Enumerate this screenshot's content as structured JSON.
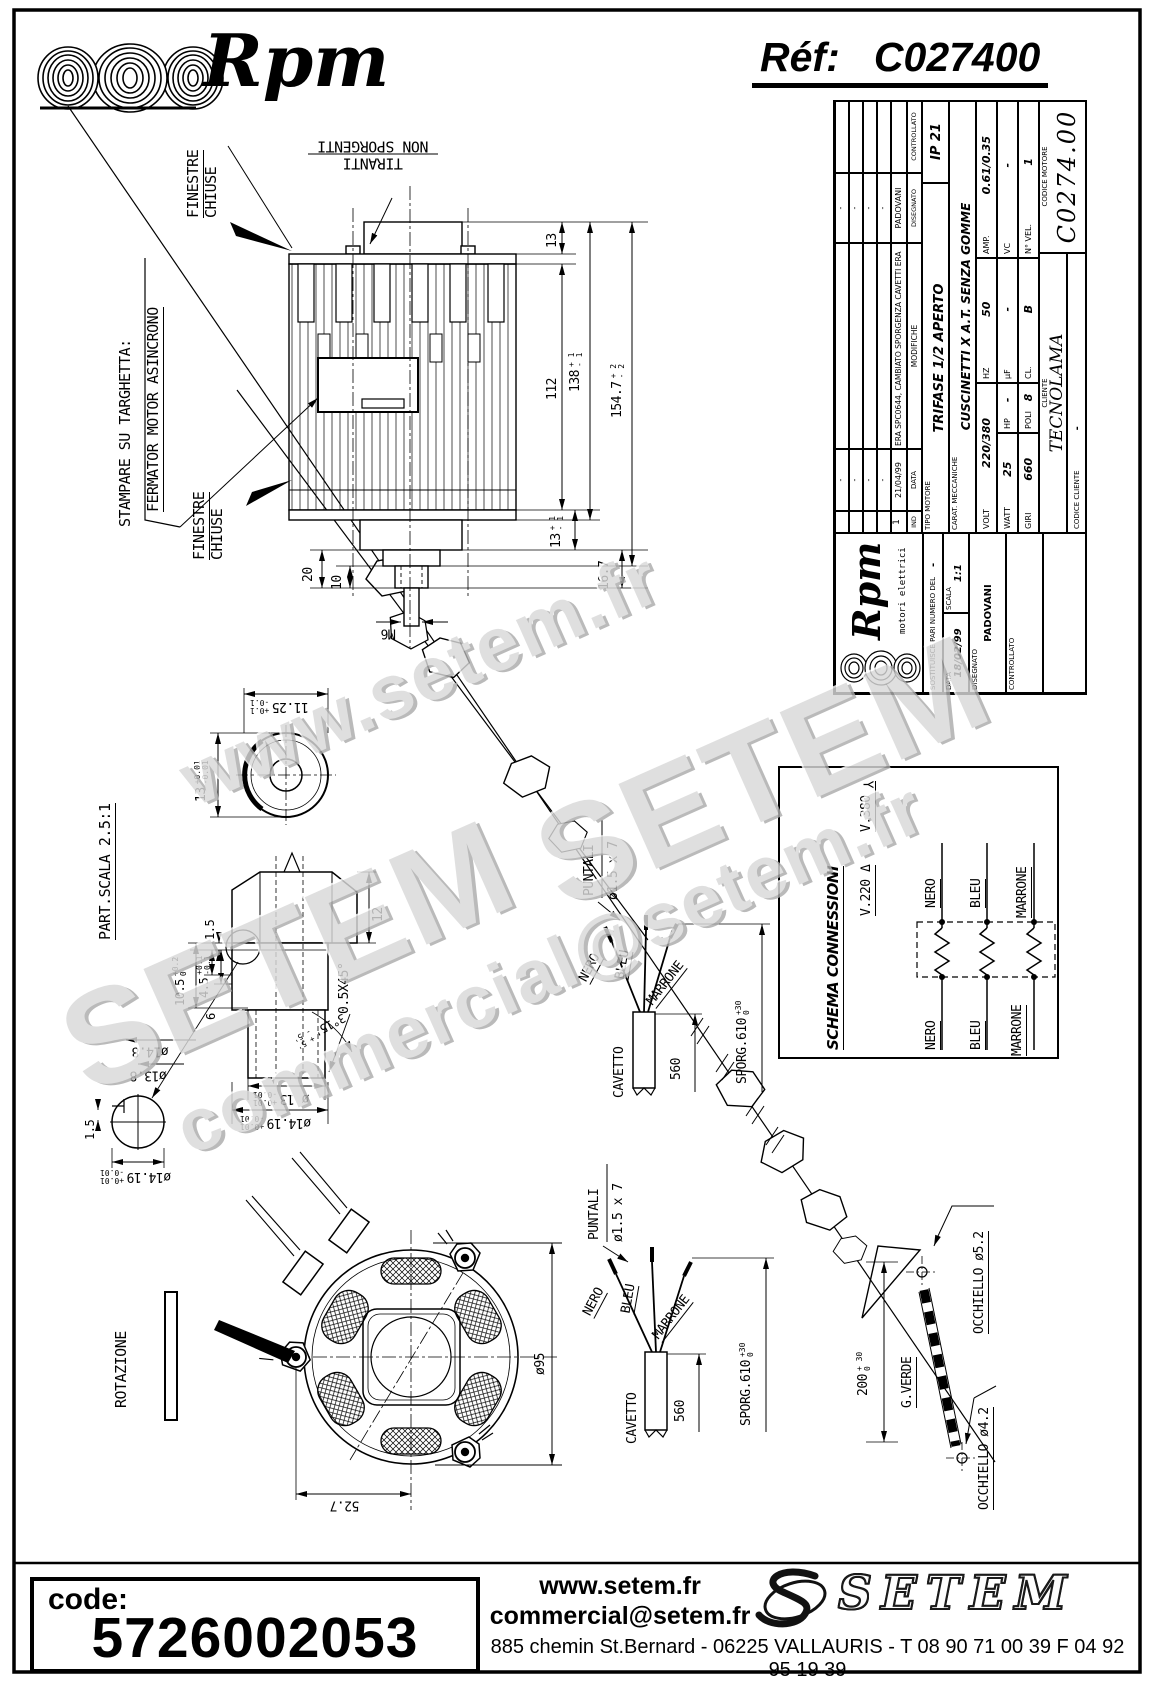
{
  "header": {
    "brand": "Rpm",
    "ref_label": "Réf:",
    "ref_value": "C027400"
  },
  "watermarks": {
    "w1": "www.setem.fr",
    "w2": "SETEM",
    "w3": "SETEM",
    "w4": "commercial@setem.fr"
  },
  "notes": {
    "finestre_a": "FINESTRE",
    "finestre_b": "CHIUSE",
    "tiranti_a": "TIRANTI",
    "tiranti_b": "NON SPORGENTI",
    "stampare_a": "STAMPARE SU TARGHETTA:",
    "stampare_b": "FERMATOR MOTOR ASINCRONO",
    "part_scala": "PART.SCALA 2.5:1",
    "rotazione": "ROTAZIONE",
    "m6": "M6"
  },
  "dims": {
    "d13": "13",
    "d112": "112",
    "d138": "138",
    "d138_tp": "+ 1",
    "d138_tm": "- 1",
    "d154": "154.7",
    "d154_tp": "+ 2",
    "d154_tm": "- 2",
    "d13b": "13",
    "d13b_tp": "+ 1",
    "d13b_tm": "- 1",
    "d167": "16.7",
    "d20": "20",
    "d10": "10",
    "d1125": "11.25",
    "d1125_tp": "+0.1",
    "d1125_tm": "-0.1",
    "d13c": "13",
    "d13c_tp": "+0.01",
    "d13c_tm": "-0.01",
    "d15": "1.5",
    "d105": "10.5",
    "d105_tp": "+0.2",
    "d105_tm": "0",
    "d45": "4.5",
    "d45_tp": "+0.1",
    "d45_tm": "-0.1",
    "d6": "6",
    "d12": "12",
    "d05x45": "0.5X45°",
    "d315": "3°15'",
    "d315_tp": "+ 5'",
    "d315_tm": "- 5'",
    "dia13": "ø 13",
    "dia13_tp": "+0.01",
    "dia13_tm": "-0.01",
    "dia1419": "ø14.19",
    "dia1419_tp": "+0.01",
    "dia1419_tm": "-0.01",
    "dia148": "ø14.8",
    "dia138": "ø13.8",
    "dia95": "ø95",
    "d527": "52.7",
    "d560": "560",
    "sporg": "SPORG.610",
    "sporg_tp": "+30",
    "sporg_tm": "0",
    "d200": "200",
    "d200_tp": "+ 30",
    "d200_tm": "0"
  },
  "cable": {
    "puntali": "PUNTALI",
    "puntali_size": "ø1.5 x 7",
    "cavetto": "CAVETTO",
    "nero": "NERO",
    "bleu": "BLEU",
    "marrone": "MARRONE",
    "gverde": "G.VERDE",
    "occ52": "OCCHIELLO ø5.2",
    "occ42": "OCCHIELLO ø4.2"
  },
  "schema": {
    "title": "SCHEMA CONNESSIONI",
    "v220": "V.220",
    "delta": "Δ",
    "v380": "V.380",
    "wye": "Y",
    "nero": "NERO",
    "bleu": "BLEU",
    "marrone": "MARRONE"
  },
  "title_block": {
    "dash": "-",
    "rev1_ind": "1",
    "rev1_date": "21/04/99",
    "rev1_desc": "ERA SPC0644, CAMBIATO SPORGENZA CAVETTI ERA 140",
    "rev1_name": "PADOVANI",
    "h_ind": "IND",
    "h_data": "DATA",
    "h_mod": "MODIFICHE",
    "h_dis": "DISEGNATO",
    "h_ctrl": "CONTROLLATO",
    "tipo_l": "TIPO MOTORE",
    "tipo_v": "TRIFASE 1/2 APERTO",
    "ip": "IP 21",
    "carat_l": "CARAT. MECCANICHE",
    "carat_v": "CUSCINETTI X A.T. SENZA GOMME",
    "volt_l": "VOLT",
    "volt_v": "220/380",
    "hz_l": "HZ",
    "hz_v": "50",
    "amp_l": "AMP.",
    "amp_v": "0.61/0.35",
    "watt_l": "WATT",
    "watt_v": "25",
    "hp_l": "HP",
    "hp_v": "-",
    "uf_l": "µF",
    "uf_v": "-",
    "vc_l": "VC",
    "vc_v": "-",
    "giri_l": "GIRI",
    "giri_v": "660",
    "poli_l": "POLI",
    "poli_v": "8",
    "cl_l": "CL.",
    "cl_v": "B",
    "nvel_l": "N° VEL.",
    "nvel_v": "1",
    "cliente_l": "CLIENTE",
    "cliente_v": "TECNOLAMA",
    "codcli_l": "CODICE CLIENTE",
    "codcli_v": "-",
    "codmot_l": "CODICE MOTORE",
    "codmot_v": "C0274.00",
    "brand": "Rpm",
    "brand_sub": "motori elettrici",
    "sost_l": "SOSTITUISCE PARI NUMERO DEL",
    "sost_v": "-",
    "data_l": "DATA",
    "data_v": "18/02/99",
    "scala_l": "SCALA",
    "scala_v": "1:1"
  },
  "footer": {
    "code_label": "code:",
    "code_value": "5726002053",
    "site": "www.setem.fr",
    "email": "commercial@setem.fr",
    "brand": "SETEM",
    "address": "885 chemin St.Bernard  -  06225 VALLAURIS  -  T 08 90 71 00 39   F 04 92 95 19 39"
  }
}
